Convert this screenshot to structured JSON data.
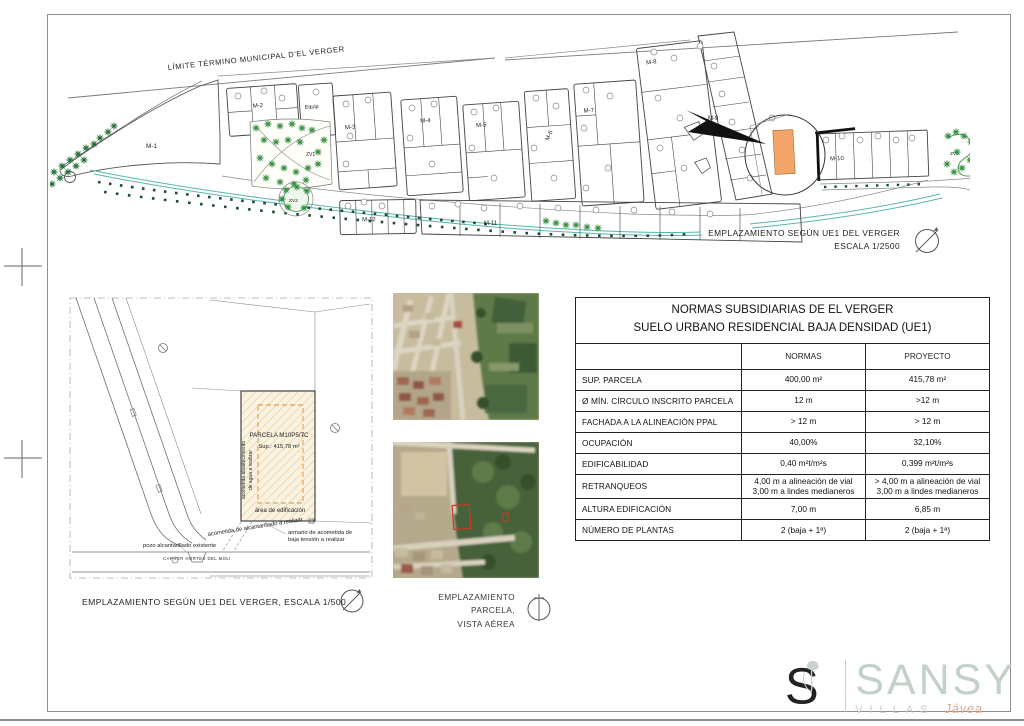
{
  "siteplan_2500": {
    "boundary_label": "LÍMITE TÉRMINO MUNICIPAL D'EL VERGER",
    "caption_line1": "EMPLAZAMIENTO SEGÚN  UE1 DEL VERGER",
    "caption_line2": "ESCALA 1/2500",
    "blocks": {
      "m1": "M-1",
      "m2": "M-2",
      "equip": "Equip",
      "m3": "M-3",
      "m4": "M-4",
      "m5": "M-5",
      "m6": "M-6",
      "m7": "M-7",
      "m8": "M-8",
      "m9": "M-9",
      "m10": "M-10",
      "m11": "M-11",
      "m12": "M-12",
      "zv1": "ZV1",
      "zv2": "ZV2",
      "zv3": "ZV3"
    }
  },
  "siteplan_500": {
    "parcel_name": "PARCELA M10P5/7C",
    "parcel_area": "Sup.:  415,78 m²",
    "area_edificacion": "área de edificación",
    "acometida_agua_line1": "acometida abastecimiento",
    "acometida_agua_line2": "de agua a realizar",
    "acometida_alcantarillado": "acometida de alcantarillado a realizar",
    "pozo": "pozo alcantarillado existente",
    "street": "CARRER HORTES DEL MOLI",
    "armario_line1": "armario de acometida de",
    "armario_line2": "baja tensión a realizar",
    "caption": "EMPLAZAMIENTO SEGÚN  UE1 DEL VERGER, ESCALA 1/500"
  },
  "aerial": {
    "caption_line1": "EMPLAZAMIENTO PARCELA,",
    "caption_line2": "VISTA AÉREA"
  },
  "normas_table": {
    "title_line1": "NORMAS SUBSIDIARIAS DE EL VERGER",
    "title_line2": "SUELO URBANO RESIDENCIAL BAJA DENSIDAD (UE1)",
    "col_normas": "NORMAS",
    "col_proyecto": "PROYECTO",
    "rows": [
      {
        "label": "SUP. PARCELA",
        "normas": "400,00 m²",
        "proyecto": "415,78 m²"
      },
      {
        "label": "Ø MÍN. CÍRCULO  INSCRITO PARCELA",
        "normas": "12 m",
        "proyecto": ">12 m"
      },
      {
        "label": "FACHADA A LA ALINEACIÓN PPAL",
        "normas": "> 12 m",
        "proyecto": "> 12 m"
      },
      {
        "label": "OCUPACIÓN",
        "normas": "40,00%",
        "proyecto": "32,10%"
      },
      {
        "label": "EDIFICABILIDAD",
        "normas": "0,40 m²t/m²s",
        "proyecto": "0,399 m²t/m²s"
      },
      {
        "label": "RETRANQUEOS",
        "normas": "4,00 m a alineación de vial\n3,00 m a lindes medianeros",
        "proyecto": "> 4,00 m a alineación de vial\n3,00 m a lindes medianeros"
      },
      {
        "label": "ALTURA EDIFICACIÓN",
        "normas": "7,00 m",
        "proyecto": "6,85 m"
      },
      {
        "label": "NÚMERO DE PLANTAS",
        "normas": "2 (baja + 1ª)",
        "proyecto": "2 (baja + 1ª)"
      }
    ]
  },
  "logo": {
    "name": "SANSY",
    "sub": "VILLAS",
    "sub2": "Jávea",
    "color": "#c4d1c8",
    "accent": "#ddaa8d"
  },
  "colors": {
    "highlight_parcel": "#f2a469",
    "teal_line": "#5ab5ae",
    "tree_green": "#2f8b3a",
    "hatch_cream": "#faf3e1",
    "dashed_orange": "#cf8f3f"
  }
}
